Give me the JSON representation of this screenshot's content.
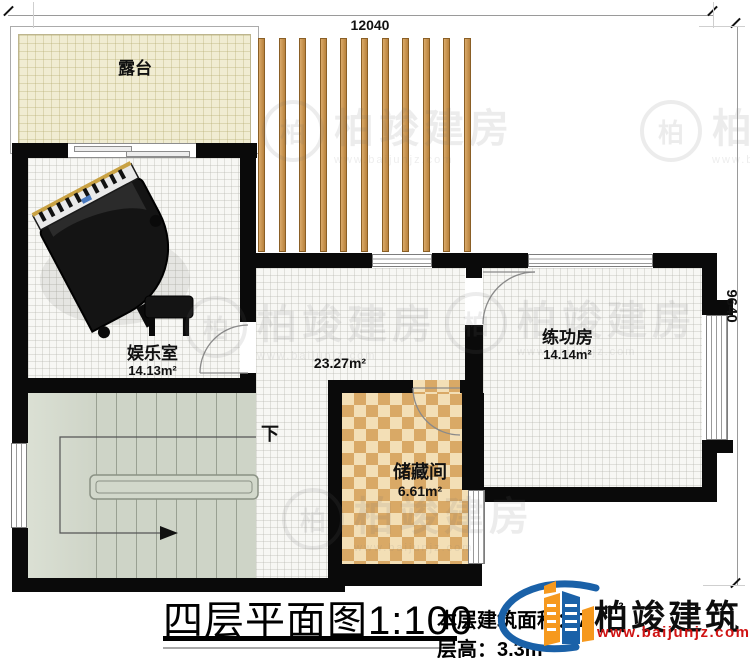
{
  "dimensions": {
    "top": "12040",
    "right": "9640"
  },
  "rooms": {
    "terrace": {
      "name": "露台"
    },
    "entertainment": {
      "name": "娱乐室",
      "area": "14.13m²"
    },
    "hall": {
      "area": "23.27m²"
    },
    "practice": {
      "name": "练功房",
      "area": "14.14m²"
    },
    "storage": {
      "name": "储藏间",
      "area": "6.61m²"
    }
  },
  "stairs": {
    "down_label": "下"
  },
  "titleblock": {
    "title": "四层平面图",
    "scale": "1:100",
    "floor_area_label": "本层建筑面积：",
    "floor_area_visible_digit": "7",
    "floor_area_unit": "m²",
    "floor_height_label": "层高：",
    "floor_height_value": "3.3m"
  },
  "logo": {
    "name": "柏竣建筑",
    "url": "www.baijunjz.com"
  },
  "watermark": {
    "badge": "柏",
    "text": "柏竣建房",
    "url": "www.baijunjz.com",
    "positions": [
      {
        "x": 262,
        "y": 96
      },
      {
        "x": 640,
        "y": 96
      },
      {
        "x": 185,
        "y": 292
      },
      {
        "x": 445,
        "y": 288
      },
      {
        "x": 282,
        "y": 484
      }
    ]
  },
  "pergola": {
    "count": 11,
    "x0": 258,
    "pitch": 20.6
  },
  "colors": {
    "wall": "#0a0a0a",
    "terrace_floor": "#f0ecd2",
    "checker_dark": "#d9a966",
    "checker_light": "#f3dfb6",
    "stair_floor": "#ced4c7",
    "slat": "#c08a44",
    "logo_blue": "#1a61a8",
    "logo_orange": "#f6991e",
    "logo_url_red": "#cf1313"
  }
}
